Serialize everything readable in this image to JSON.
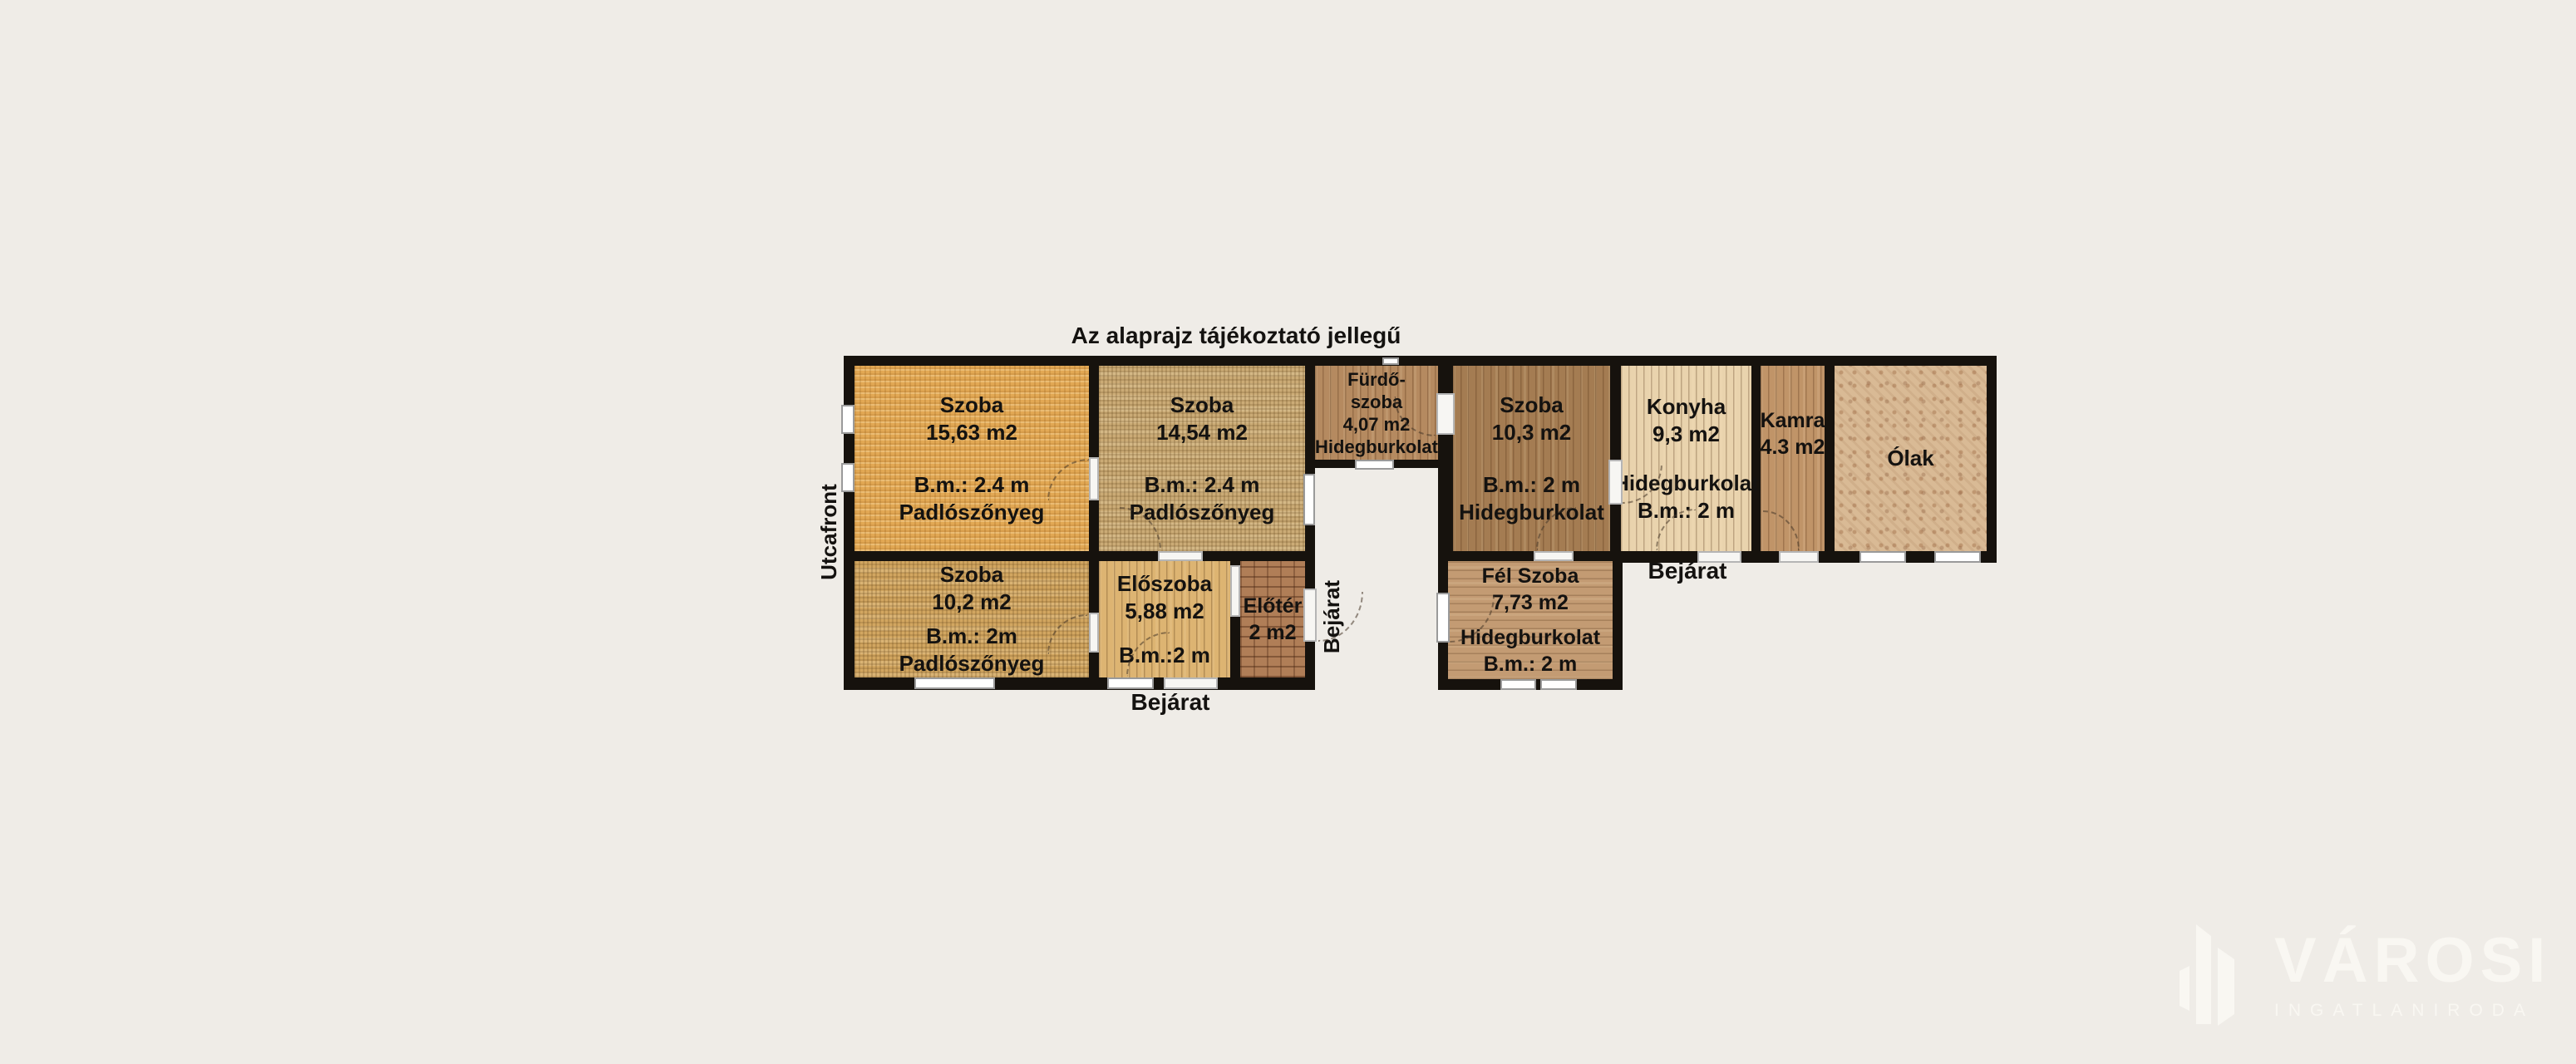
{
  "title": "Az alaprajz tájékoztató jellegű",
  "side_labels": {
    "utcafront": "Utcafront",
    "bejarat_main": "Bejárat",
    "bejarat_side": "Bejárat",
    "bejarat_courtyard": "Bejárat"
  },
  "rooms": {
    "szoba_15_63": {
      "l1": "Szoba",
      "l2": "15,63 m2",
      "l3": "B.m.: 2.4 m",
      "l4": "Padlószőnyeg"
    },
    "szoba_14_54": {
      "l1": "Szoba",
      "l2": "14,54 m2",
      "l3": "B.m.: 2.4 m",
      "l4": "Padlószőnyeg"
    },
    "furdoszoba": {
      "l1": "Fürdő-",
      "l2": "szoba",
      "l3": "4,07 m2",
      "l4": "Hidegburkolat"
    },
    "szoba_10_3": {
      "l1": "Szoba",
      "l2": "10,3 m2",
      "l3": "B.m.: 2 m",
      "l4": "Hidegburkolat"
    },
    "konyha": {
      "l1": "Konyha",
      "l2": "9,3 m2",
      "l3": "Hidegburkolat",
      "l4": "B.m.: 2 m"
    },
    "kamra": {
      "l1": "Kamra",
      "l2": "4.3 m2"
    },
    "olak": {
      "l1": "Ólak"
    },
    "szoba_10_2": {
      "l1": "Szoba",
      "l2": "10,2 m2",
      "l3": "B.m.: 2m",
      "l4": "Padlószőnyeg"
    },
    "eloszoba": {
      "l1": "Előszoba",
      "l2": "5,88 m2",
      "l3": "B.m.:2 m"
    },
    "eloter": {
      "l1": "Előtér",
      "l2": "2 m2"
    },
    "fel_szoba": {
      "l1": "Fél Szoba",
      "l2": "7,73 m2",
      "l3": "Hidegburkolat",
      "l4": "B.m.: 2 m"
    }
  },
  "watermark": {
    "brand": "VÁROSI",
    "tagline": "INGATLANIRODA"
  },
  "colors": {
    "background": "#efece7",
    "wall": "#16120d",
    "window": "#ffffff",
    "room_szoba_15_63": "#e2a854",
    "room_szoba_14_54": "#cbab76",
    "room_furdoszoba": "#b58a60",
    "room_szoba_10_3": "#a47c52",
    "room_konyha": "#e9d3ad",
    "room_kamra": "#c09468",
    "room_olak": "#d9ba95",
    "room_szoba_10_2": "#d2a660",
    "room_eloszoba": "#ddb472",
    "room_eloter": "#b07e57",
    "room_fel_szoba": "#c39b73",
    "watermark": "#f9f7f2"
  }
}
